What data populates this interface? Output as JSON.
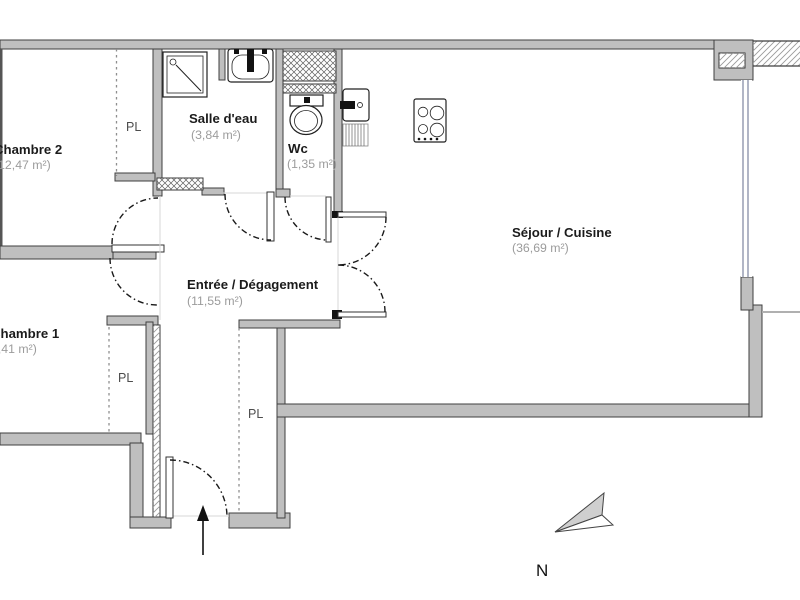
{
  "title": "Apartment floor plan",
  "colors": {
    "wall_fill": "#bfbfbf",
    "wall_edge": "#3f3f3f",
    "window": "#9096ad",
    "door_arc": "#1a1a1a",
    "room_name": "#1b1b1b",
    "room_area": "#9c9c9c",
    "closet_label": "#4d4d4d"
  },
  "rooms": {
    "chambre2": {
      "name": "Chambre 2",
      "area": "(12,47 m²)"
    },
    "salle_deau": {
      "name": "Salle d'eau",
      "area": "(3,84 m²)"
    },
    "wc": {
      "name": "Wc",
      "area": "(1,35 m²)"
    },
    "sejour_cuisine": {
      "name": "Séjour / Cuisine",
      "area": "(36,69 m²)"
    },
    "entree": {
      "name": "Entrée / Dégagement",
      "area": "(11,55 m²)"
    },
    "chambre1": {
      "name": "Chambre 1",
      "area": "(11,41 m²)"
    }
  },
  "closets": {
    "chambre2_pl": "PL",
    "chambre1_pl": "PL",
    "entree_pl": "PL"
  },
  "compass": {
    "north_label": "N"
  }
}
